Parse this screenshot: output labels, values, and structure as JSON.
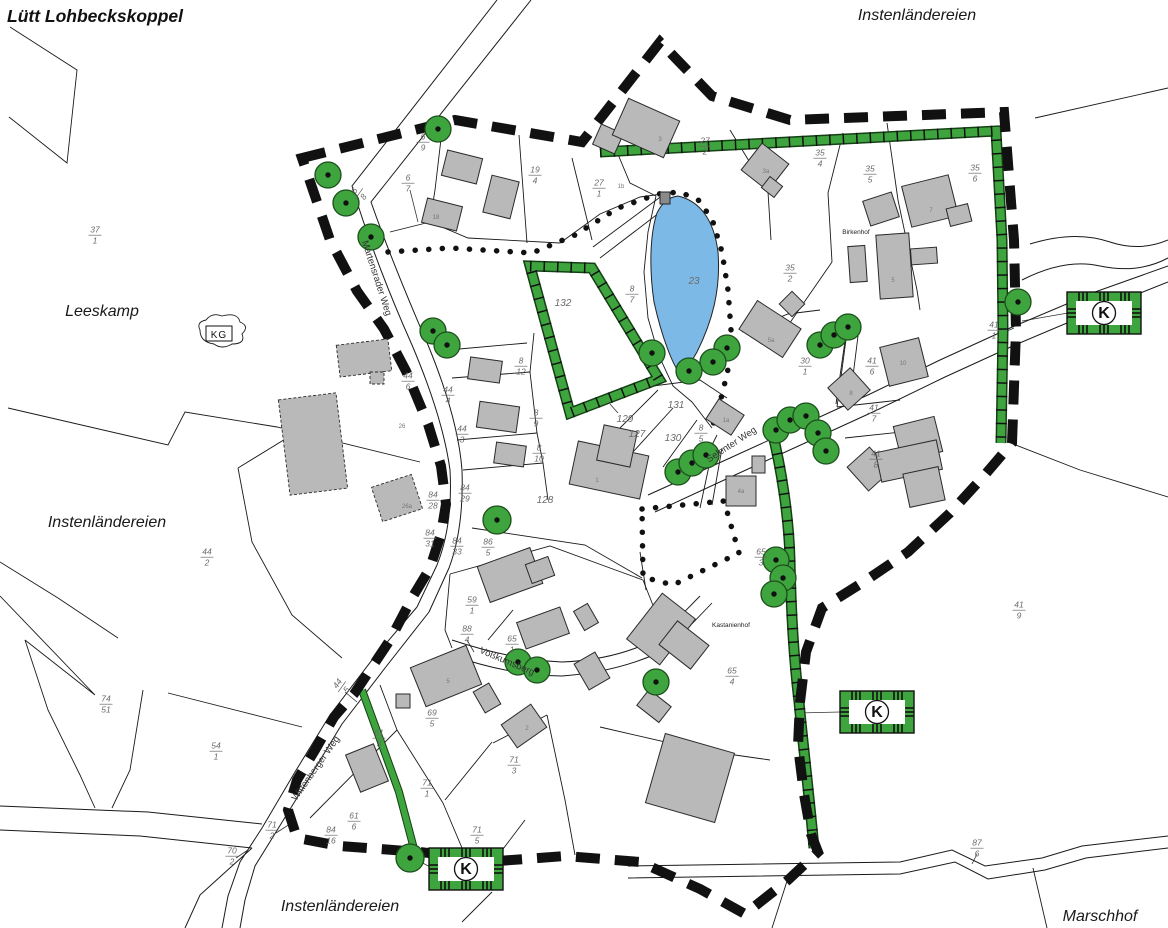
{
  "map": {
    "colors": {
      "green": "#3ea43e",
      "pond_blue": "#7cb9e6",
      "building_gray": "#b9b9b9",
      "boundary_black": "#111111",
      "label_gray": "#6b6b6b"
    },
    "k_letter": "K",
    "kg_label": "KG",
    "k_boxes": [
      {
        "x": 1104,
        "y": 313
      },
      {
        "x": 877,
        "y": 712
      },
      {
        "x": 466,
        "y": 869
      }
    ],
    "labels": [
      {
        "text": "Lütt Lohbeckskoppel",
        "x": 95,
        "y": 22,
        "cls": "place-bold",
        "name": "place-label-luett-lohbeckskoppel"
      },
      {
        "text": "Instenländereien",
        "x": 917,
        "y": 20,
        "cls": "place",
        "name": "place-label-instenlaendereien-ne"
      },
      {
        "text": "Leeskamp",
        "x": 102,
        "y": 316,
        "cls": "place",
        "name": "place-label-leeskamp"
      },
      {
        "text": "Instenländereien",
        "x": 107,
        "y": 527,
        "cls": "place",
        "name": "place-label-instenlaendereien-w"
      },
      {
        "text": "Instenländereien",
        "x": 340,
        "y": 911,
        "cls": "place",
        "name": "place-label-instenlaendereien-s"
      },
      {
        "text": "Marschhof",
        "x": 1100,
        "y": 921,
        "cls": "place",
        "name": "place-label-marschhof"
      },
      {
        "text": "Martensrader Weg",
        "x": 374,
        "y": 279,
        "cls": "street",
        "rotate": 72,
        "name": "street-label-martensrader-weg"
      },
      {
        "text": "Selenter Weg",
        "x": 733,
        "y": 447,
        "cls": "street",
        "rotate": -33,
        "name": "street-label-selenter-weg"
      },
      {
        "text": "Wittenberger Weg",
        "x": 318,
        "y": 770,
        "cls": "street",
        "rotate": -55,
        "name": "street-label-wittenberger-weg"
      },
      {
        "text": "Voßkumsberg",
        "x": 506,
        "y": 664,
        "cls": "street",
        "rotate": 23,
        "name": "street-label-vosskumsberg"
      },
      {
        "text": "Birkenhof",
        "x": 856,
        "y": 234,
        "cls": "farm",
        "name": "farm-label-birkenhof"
      },
      {
        "text": "Kastanienhof",
        "x": 731,
        "y": 627,
        "cls": "farm",
        "name": "farm-label-kastanienhof"
      },
      {
        "text": "132",
        "x": 563,
        "y": 306,
        "cls": "plain",
        "name": "area-label-132"
      },
      {
        "text": "23",
        "x": 694,
        "y": 284,
        "cls": "plain",
        "name": "area-label-23-pond"
      },
      {
        "text": "128",
        "x": 545,
        "y": 503,
        "cls": "plain",
        "name": "area-label-128"
      },
      {
        "text": "127",
        "x": 637,
        "y": 437,
        "cls": "plain",
        "name": "area-label-127"
      },
      {
        "text": "129",
        "x": 625,
        "y": 422,
        "cls": "plain",
        "name": "area-label-129"
      },
      {
        "text": "130",
        "x": 673,
        "y": 441,
        "cls": "plain",
        "name": "area-label-130"
      },
      {
        "text": "131",
        "x": 676,
        "y": 408,
        "cls": "plain",
        "name": "area-label-131"
      },
      {
        "text": "3",
        "x": 660,
        "y": 141,
        "cls": "house",
        "name": "house-number"
      },
      {
        "text": "1b",
        "x": 621,
        "y": 188,
        "cls": "house",
        "name": "house-number"
      },
      {
        "text": "3a",
        "x": 766,
        "y": 173,
        "cls": "house",
        "name": "house-number"
      },
      {
        "text": "7",
        "x": 931,
        "y": 212,
        "cls": "house",
        "name": "house-number"
      },
      {
        "text": "5",
        "x": 893,
        "y": 282,
        "cls": "house",
        "name": "house-number"
      },
      {
        "text": "5a",
        "x": 771,
        "y": 342,
        "cls": "house",
        "name": "house-number"
      },
      {
        "text": "10",
        "x": 903,
        "y": 365,
        "cls": "house",
        "name": "house-number"
      },
      {
        "text": "8",
        "x": 851,
        "y": 395,
        "cls": "house",
        "name": "house-number"
      },
      {
        "text": "1a",
        "x": 726,
        "y": 422,
        "cls": "house",
        "name": "house-number"
      },
      {
        "text": "4a",
        "x": 741,
        "y": 493,
        "cls": "house",
        "name": "house-number"
      },
      {
        "text": "18",
        "x": 436,
        "y": 219,
        "cls": "house",
        "name": "house-number"
      },
      {
        "text": "26",
        "x": 402,
        "y": 428,
        "cls": "house",
        "name": "house-number"
      },
      {
        "text": "26a",
        "x": 407,
        "y": 508,
        "cls": "house",
        "name": "house-number"
      },
      {
        "text": "1",
        "x": 597,
        "y": 482,
        "cls": "house",
        "name": "house-number"
      },
      {
        "text": "5",
        "x": 448,
        "y": 683,
        "cls": "house",
        "name": "house-number"
      },
      {
        "text": "2",
        "x": 527,
        "y": 730,
        "cls": "house",
        "name": "house-number"
      }
    ],
    "parcel_fractions": [
      {
        "num": "37",
        "den": "1",
        "x": 95,
        "y": 234
      },
      {
        "num": "6",
        "den": "9",
        "x": 423,
        "y": 141
      },
      {
        "num": "6",
        "den": "7",
        "x": 408,
        "y": 182
      },
      {
        "num": "6",
        "den": "8",
        "x": 358,
        "y": 193,
        "rotate": -55
      },
      {
        "num": "19",
        "den": "4",
        "x": 535,
        "y": 174
      },
      {
        "num": "27",
        "den": "1",
        "x": 599,
        "y": 187
      },
      {
        "num": "27",
        "den": "2",
        "x": 705,
        "y": 145
      },
      {
        "num": "35",
        "den": "4",
        "x": 820,
        "y": 157
      },
      {
        "num": "35",
        "den": "5",
        "x": 870,
        "y": 173
      },
      {
        "num": "35",
        "den": "6",
        "x": 975,
        "y": 172
      },
      {
        "num": "35",
        "den": "2",
        "x": 790,
        "y": 272
      },
      {
        "num": "8",
        "den": "7",
        "x": 632,
        "y": 293
      },
      {
        "num": "8",
        "den": "12",
        "x": 521,
        "y": 365
      },
      {
        "num": "8",
        "den": "9",
        "x": 536,
        "y": 417
      },
      {
        "num": "8",
        "den": "10",
        "x": 539,
        "y": 452
      },
      {
        "num": "44",
        "den": "6",
        "x": 408,
        "y": 380
      },
      {
        "num": "44",
        "den": "4",
        "x": 448,
        "y": 394
      },
      {
        "num": "44",
        "den": "3",
        "x": 462,
        "y": 433
      },
      {
        "num": "84",
        "den": "29",
        "x": 465,
        "y": 492
      },
      {
        "num": "84",
        "den": "28",
        "x": 433,
        "y": 499
      },
      {
        "num": "84",
        "den": "31",
        "x": 430,
        "y": 537
      },
      {
        "num": "84",
        "den": "33",
        "x": 457,
        "y": 545
      },
      {
        "num": "86",
        "den": "5",
        "x": 488,
        "y": 546
      },
      {
        "num": "8",
        "den": "5",
        "x": 701,
        "y": 432
      },
      {
        "num": "30",
        "den": "1",
        "x": 805,
        "y": 365
      },
      {
        "num": "41",
        "den": "6",
        "x": 872,
        "y": 365
      },
      {
        "num": "41",
        "den": "7",
        "x": 874,
        "y": 412
      },
      {
        "num": "41",
        "den": "8",
        "x": 876,
        "y": 458
      },
      {
        "num": "41",
        "den": "1",
        "x": 994,
        "y": 329
      },
      {
        "num": "41",
        "den": "9",
        "x": 1019,
        "y": 609
      },
      {
        "num": "65",
        "den": "3",
        "x": 761,
        "y": 556
      },
      {
        "num": "65",
        "den": "4",
        "x": 732,
        "y": 675
      },
      {
        "num": "65",
        "den": "1",
        "x": 512,
        "y": 643
      },
      {
        "num": "59",
        "den": "1",
        "x": 472,
        "y": 604
      },
      {
        "num": "88",
        "den": "4",
        "x": 467,
        "y": 633
      },
      {
        "num": "69",
        "den": "5",
        "x": 432,
        "y": 717
      },
      {
        "num": "61",
        "den": "3",
        "x": 379,
        "y": 737
      },
      {
        "num": "61",
        "den": "6",
        "x": 354,
        "y": 820
      },
      {
        "num": "84",
        "den": "16",
        "x": 331,
        "y": 834
      },
      {
        "num": "71",
        "den": "1",
        "x": 427,
        "y": 787
      },
      {
        "num": "71",
        "den": "3",
        "x": 514,
        "y": 764
      },
      {
        "num": "71",
        "den": "5",
        "x": 477,
        "y": 834
      },
      {
        "num": "71",
        "den": "2",
        "x": 272,
        "y": 829
      },
      {
        "num": "70",
        "den": "2",
        "x": 232,
        "y": 855
      },
      {
        "num": "54",
        "den": "1",
        "x": 216,
        "y": 750
      },
      {
        "num": "74",
        "den": "51",
        "x": 106,
        "y": 703
      },
      {
        "num": "44",
        "den": "2",
        "x": 207,
        "y": 556
      },
      {
        "num": "44",
        "den": "5",
        "x": 341,
        "y": 686,
        "rotate": -55
      },
      {
        "num": "87",
        "den": "6",
        "x": 977,
        "y": 847
      }
    ],
    "trees": [
      {
        "x": 328,
        "y": 175
      },
      {
        "x": 346,
        "y": 203
      },
      {
        "x": 371,
        "y": 237
      },
      {
        "x": 438,
        "y": 129
      },
      {
        "x": 433,
        "y": 331
      },
      {
        "x": 447,
        "y": 345
      },
      {
        "x": 497,
        "y": 520,
        "r": 14
      },
      {
        "x": 652,
        "y": 353
      },
      {
        "x": 727,
        "y": 348
      },
      {
        "x": 713,
        "y": 362
      },
      {
        "x": 689,
        "y": 371
      },
      {
        "x": 820,
        "y": 345
      },
      {
        "x": 834,
        "y": 335
      },
      {
        "x": 848,
        "y": 327
      },
      {
        "x": 776,
        "y": 430
      },
      {
        "x": 790,
        "y": 420
      },
      {
        "x": 806,
        "y": 416
      },
      {
        "x": 818,
        "y": 433
      },
      {
        "x": 826,
        "y": 451
      },
      {
        "x": 776,
        "y": 560
      },
      {
        "x": 783,
        "y": 578
      },
      {
        "x": 774,
        "y": 594
      },
      {
        "x": 678,
        "y": 472
      },
      {
        "x": 692,
        "y": 463
      },
      {
        "x": 706,
        "y": 455
      },
      {
        "x": 518,
        "y": 662
      },
      {
        "x": 537,
        "y": 670
      },
      {
        "x": 656,
        "y": 682
      },
      {
        "x": 410,
        "y": 858,
        "r": 14
      },
      {
        "x": 1018,
        "y": 302
      }
    ]
  }
}
